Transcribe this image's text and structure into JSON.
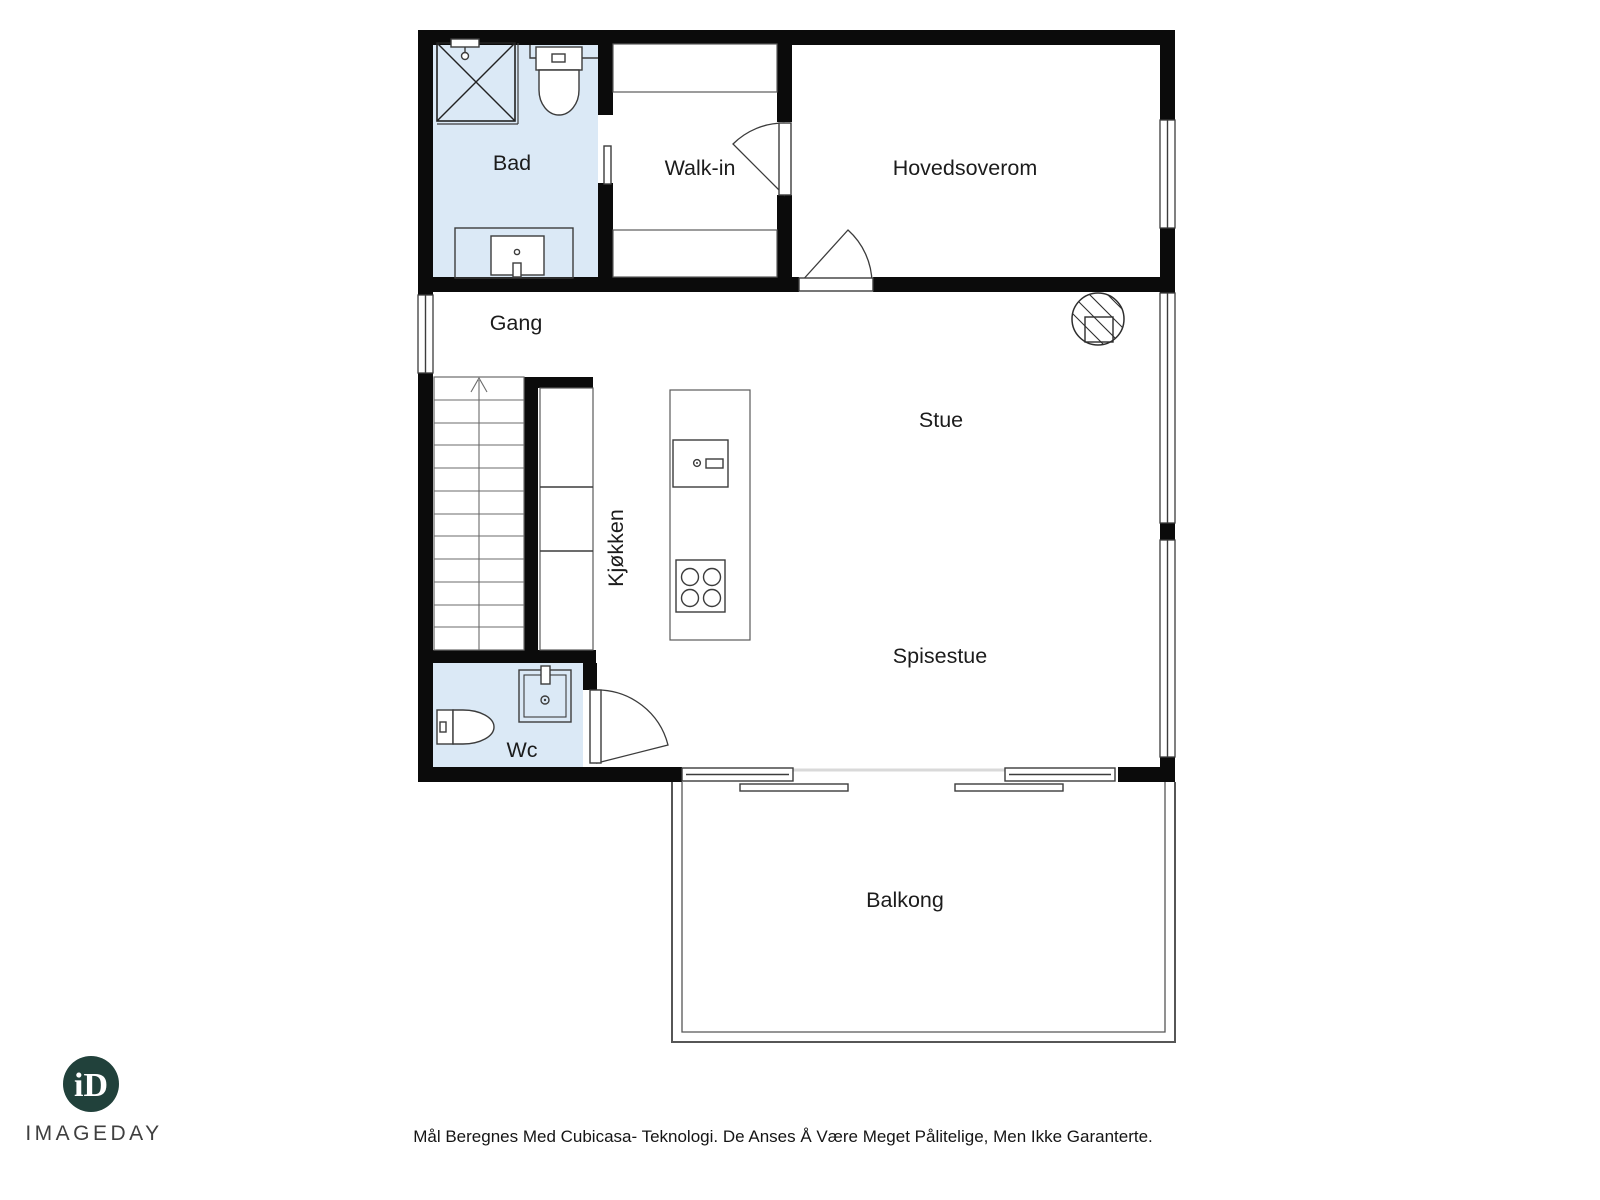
{
  "floorplan": {
    "rooms": {
      "bad": {
        "label": "Bad"
      },
      "walk_in": {
        "label": "Walk-in"
      },
      "hovedsoverom": {
        "label": "Hovedsoverom"
      },
      "gang": {
        "label": "Gang"
      },
      "stue": {
        "label": "Stue"
      },
      "kjokken": {
        "label": "Kjøkken"
      },
      "spisestue": {
        "label": "Spisestue"
      },
      "wc": {
        "label": "Wc"
      },
      "balkong": {
        "label": "Balkong"
      }
    },
    "colors": {
      "wet_room_fill": "#dbe9f6",
      "wall": "#0b0b0b"
    }
  },
  "branding": {
    "logo_monogram": "iD",
    "logo_name": "IMAGEDAY",
    "logo_color": "#21413b"
  },
  "footer": {
    "disclaimer": "Mål Beregnes Med Cubicasa- Teknologi. De Anses Å Være Meget Pålitelige, Men Ikke Garanterte."
  }
}
